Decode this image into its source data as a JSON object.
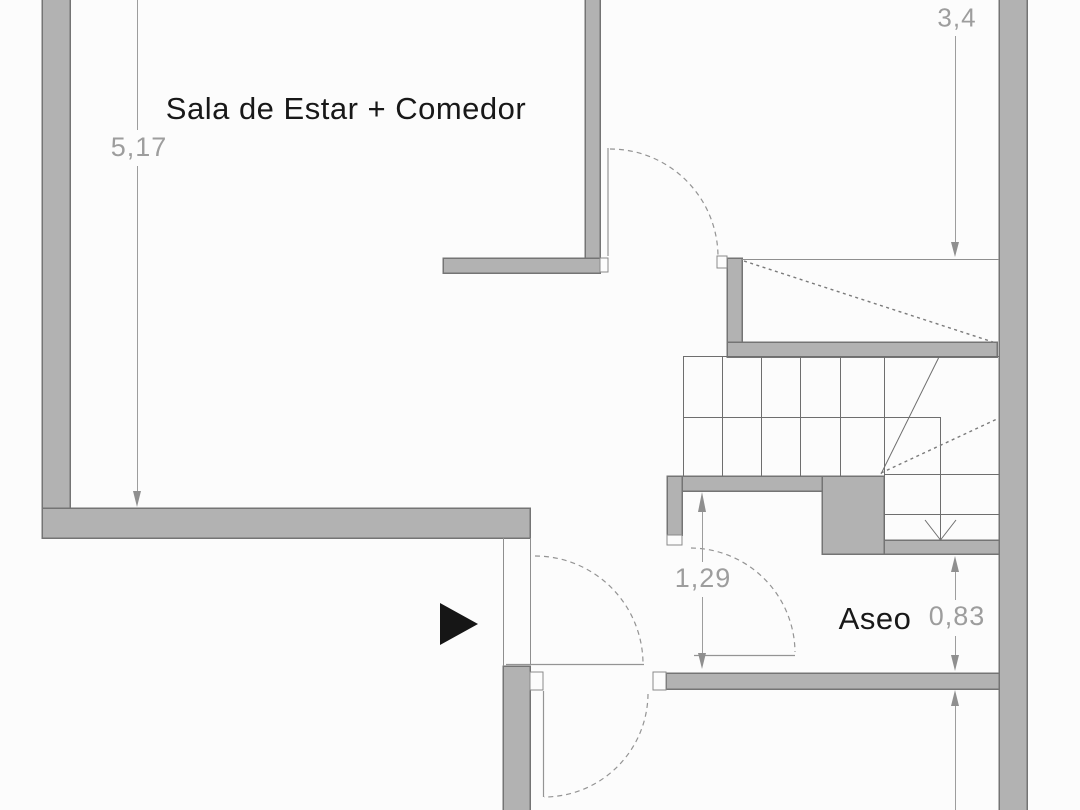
{
  "plan": {
    "rooms": {
      "living_dining": "Sala de Estar + Comedor",
      "bathroom": "Aseo"
    },
    "dimensions": {
      "living_height": "5,17",
      "landing_depth": "3,4",
      "hall_height": "1,29",
      "bathroom_height": "0,83"
    },
    "icons": {
      "entrance_arrow": "right-pointing-triangle",
      "stair_direction": "down-chevron-arrow"
    },
    "colors": {
      "background": "#fcfcfc",
      "wall_fill": "#b2b2b2",
      "wall_edge": "#747474",
      "thin_line": "#8f8f8f",
      "tread_line": "#6e6e6e",
      "door_line": "#949494",
      "dimension_text": "#9d9d9d",
      "room_text": "#181818",
      "entrance_arrow": "#161616"
    }
  }
}
